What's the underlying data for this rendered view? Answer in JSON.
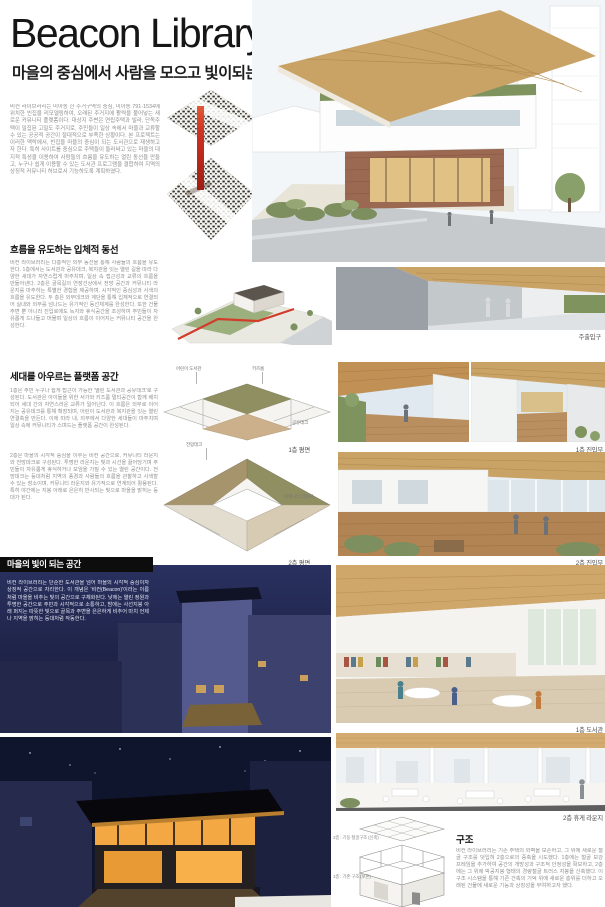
{
  "poster": {
    "title": "Beacon Library",
    "subtitle": "마을의 중심에서 사람을 모으고 빛이되는 도서관",
    "intro": "비컨 라이브러리는 미아동 한 주거구역의 중심, 미아동 791-1534에 위치한 빈집을 리모델링하여, 오래된 주거지에 활력을 불어넣는 새로운 커뮤니티 플랫폼이다. 대상지 주변은 연립주택과 빌라, 단독주택이 밀집된 고밀도 주거지로, 주민들이 일상 속에서 마을과 교류할 수 있는 공공적 공간이 절대적으로 부족한 상황이다. 본 프로젝트는 이러한 맥락에서, 빈집을 마을의 중심이 되는 도서관으로 재생하고자 한다. 특히 사이트를 중심으로 주택들이 둘러싸고 있는 마을의 대지적 특성을 이용하여 사람들의 흐름을 유도하는 열린 동선을 만들고, 누구나 쉽게 이용할 수 있는 도서관 프로그램을 결합하여 지역의 상징적 커뮤니티 허브로서 기능하도록 계획하였다."
  },
  "sections": {
    "flow": {
      "title": "흐름을 유도하는 입체적 동선",
      "body": "비컨 라이브러리는 다층적인 외부 동선을 통해 사람들의 흐름을 유도한다. 1층에서는 도서관과 공유데크, 복지관을 잇는 열린 길을 따라 다양한 세대가 자연스럽게 마주치며, 일상 속 접근성과 교류의 흐름을 만들어낸다. 2층은 골목길의 연장선상에서 전망 공간과 커뮤니티 라운지를 마주하는 특별한 경험을 제공하며, 시각적인 중심성과 사색의 흐름을 유도한다. 두 층은 외부데크와 계단을 통해 입체적으로 연결되어 실내와 외부를 넘나드는 유기적인 동선체계를 완성한다. 또한 건물 주변 뿐 아니라 진입로에도 녹지와 휴식공간을 조성하여 주민들이 자유롭게 드나들고 머물며 일상의 흐름이 이어지는 커뮤니티 공간을 완성한다."
    },
    "platform": {
      "title": "세대를 아우르는 플랫폼 공간",
      "body1": "1층은 주민 누구나 쉽게 접근이 가능한 '열린 도서관과 공유데크'로 구성된다. 도서관은 아이들을 위한 서가와 키즈룸 멀티공간이 함께 배치되어 세대 간의 자연스러운 교류가 일어난다. 이 흐름은 외부로 이어지는 공유데크를 통해 확장되며, 어린이 도서관과 복지관을 잇는 열린 연결축을 만든다. 이에 따라 내, 외부에서 다양한 세대들이 마주치며 일상 속에 커뮤니티가 스며드는 플랫폼 공간이 완성된다.",
      "body2": "2층은 마을의 시각적 중심을 이루는 비컨 공간으로, 커뮤니티 라운지와 전망데크로 구성된다. 투명한 라운지는 빛과 시선을 끌어당기며 주민들이 자유롭게 휴식하거나 모임을 가질 수 있는 열린 공간이다. 전망데크는 등대처럼 지역의 풍경과 사람들의 흐름을 관찰하고 사색할 수 있는 장소이며, 커뮤니티 라운지와 유기적으로 연계되어 활용된다. 특히 야간에는 지붕 아래로 은은히 반사되는 빛으로 마을을 밝히는 등대가 된다."
    },
    "light": {
      "title": "마을의 빛이 되는 공간",
      "body": "비컨 라이브러리는 단순한 도서관을 넘어 마을의 시각적 중심이자 상징적 공간으로 자리한다. 이 개념은 '비컨(Beacon)'이라는 이름처럼 마을을 비추는 빛의 공간으로 구체화된다. 낮에는 열린 정원과 투명한 공간으로 주민과 시각적으로 소통하고, 밤에는 사선지붕 아래 퍼지는 따뜻한 빛으로 골목과 주변을 은은하게 비추어 마치 언제나 지역을 밝히는 등대처럼 작동한다."
    },
    "structure": {
      "title": "구조",
      "body": "비컨 라이브러리는 기존 주택의 외벽을 보존하고, 그 위에 새로운 철골 구조를 덧입혀 2층으로의 증축을 시도했다. 1층에는 철골 보강 프레임을 추가하여 공간의 개방성과 구조적 안정성을 확보하고, 2층에는 그 위에 박공지붕 형태의 경량철골 트러스 지붕을 신축했다. 이 구조 시스템을 통해 기존 건축의 기억 위에 새로운 층위를 더하고 오래된 건물에 새로운 기능과 상징성을 부여하고자 했다.",
      "labels": [
        "2층 : 기둥 철골구조 (신축)",
        "1층 : 기존 구조 (보존)"
      ]
    }
  },
  "captions": {
    "main_entrance": "주출입구",
    "plan1": "1층 평면",
    "entry1": "1층 진입부",
    "plan2": "2층 평면",
    "entry2": "2층 진입부",
    "library1": "1층 도서관",
    "lounge2": "2층 휴게 라운지"
  },
  "plans": {
    "plan1": {
      "labels": [
        "어린이 도서관",
        "키즈룸",
        "공유데크"
      ]
    },
    "plan2": {
      "labels": [
        "전망데크",
        "커뮤니티 라운지"
      ]
    }
  },
  "colors": {
    "accent_red": "#cf3222",
    "wood": "#c9a265",
    "night_navy": "#1b2142",
    "glow_orange": "#f3a843",
    "ink": "#141414",
    "body_gray": "#8f8f8f"
  }
}
